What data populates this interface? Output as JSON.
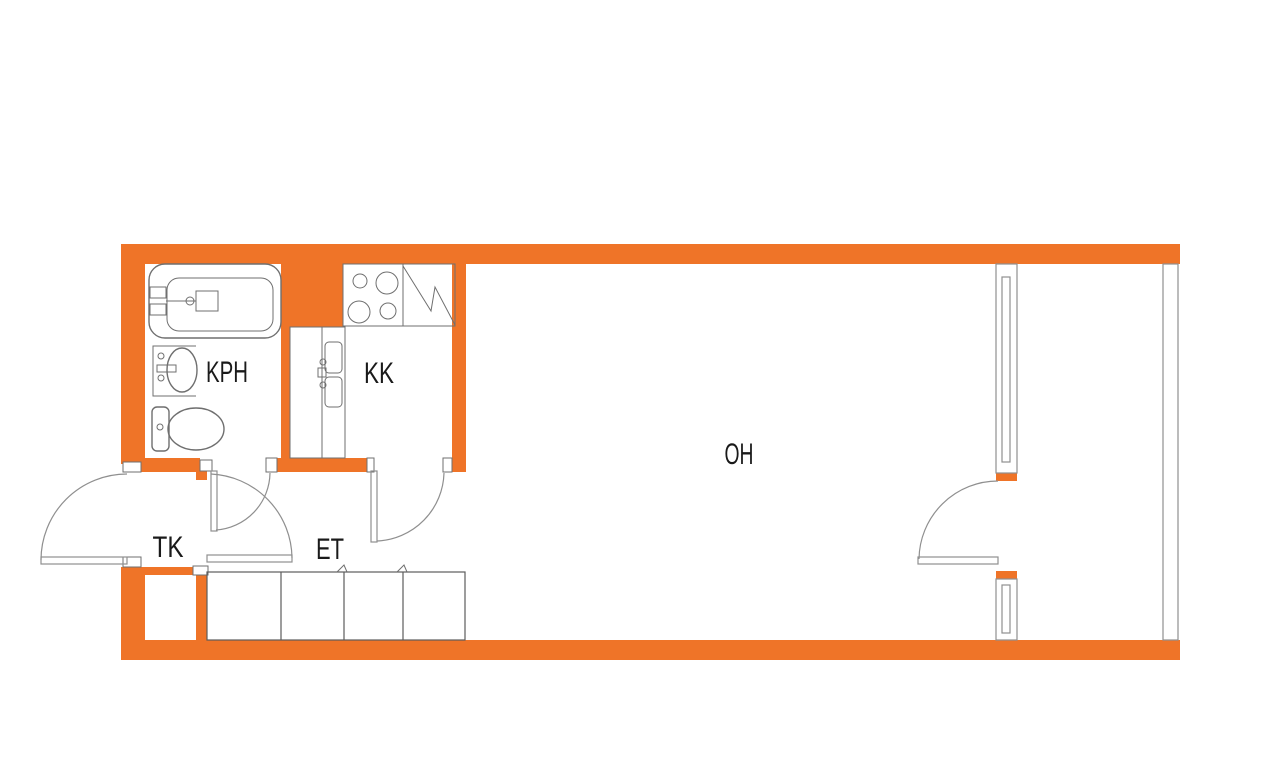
{
  "title": "Studio apartment floor plan",
  "colors": {
    "wall": "#EF7428",
    "line": "#6f6f6f",
    "door": "#8f8f8f",
    "text": "#1a1a1a",
    "bg": "#ffffff"
  },
  "rooms": {
    "kph": {
      "label": "KPH"
    },
    "kk": {
      "label": "KK"
    },
    "oh": {
      "label": "OH"
    },
    "tk": {
      "label": "TK"
    },
    "et": {
      "label": "ET"
    }
  },
  "fixtures": [
    "bathtub",
    "washbasin",
    "toilet",
    "stove",
    "fridge-freezer",
    "kitchen-counter",
    "kitchen-sink",
    "wardrobes",
    "closet",
    "entrance-door",
    "bathroom-door",
    "hall-door",
    "kitchen-door",
    "balcony-door",
    "window-upper",
    "window-lower",
    "balcony-glazing"
  ]
}
